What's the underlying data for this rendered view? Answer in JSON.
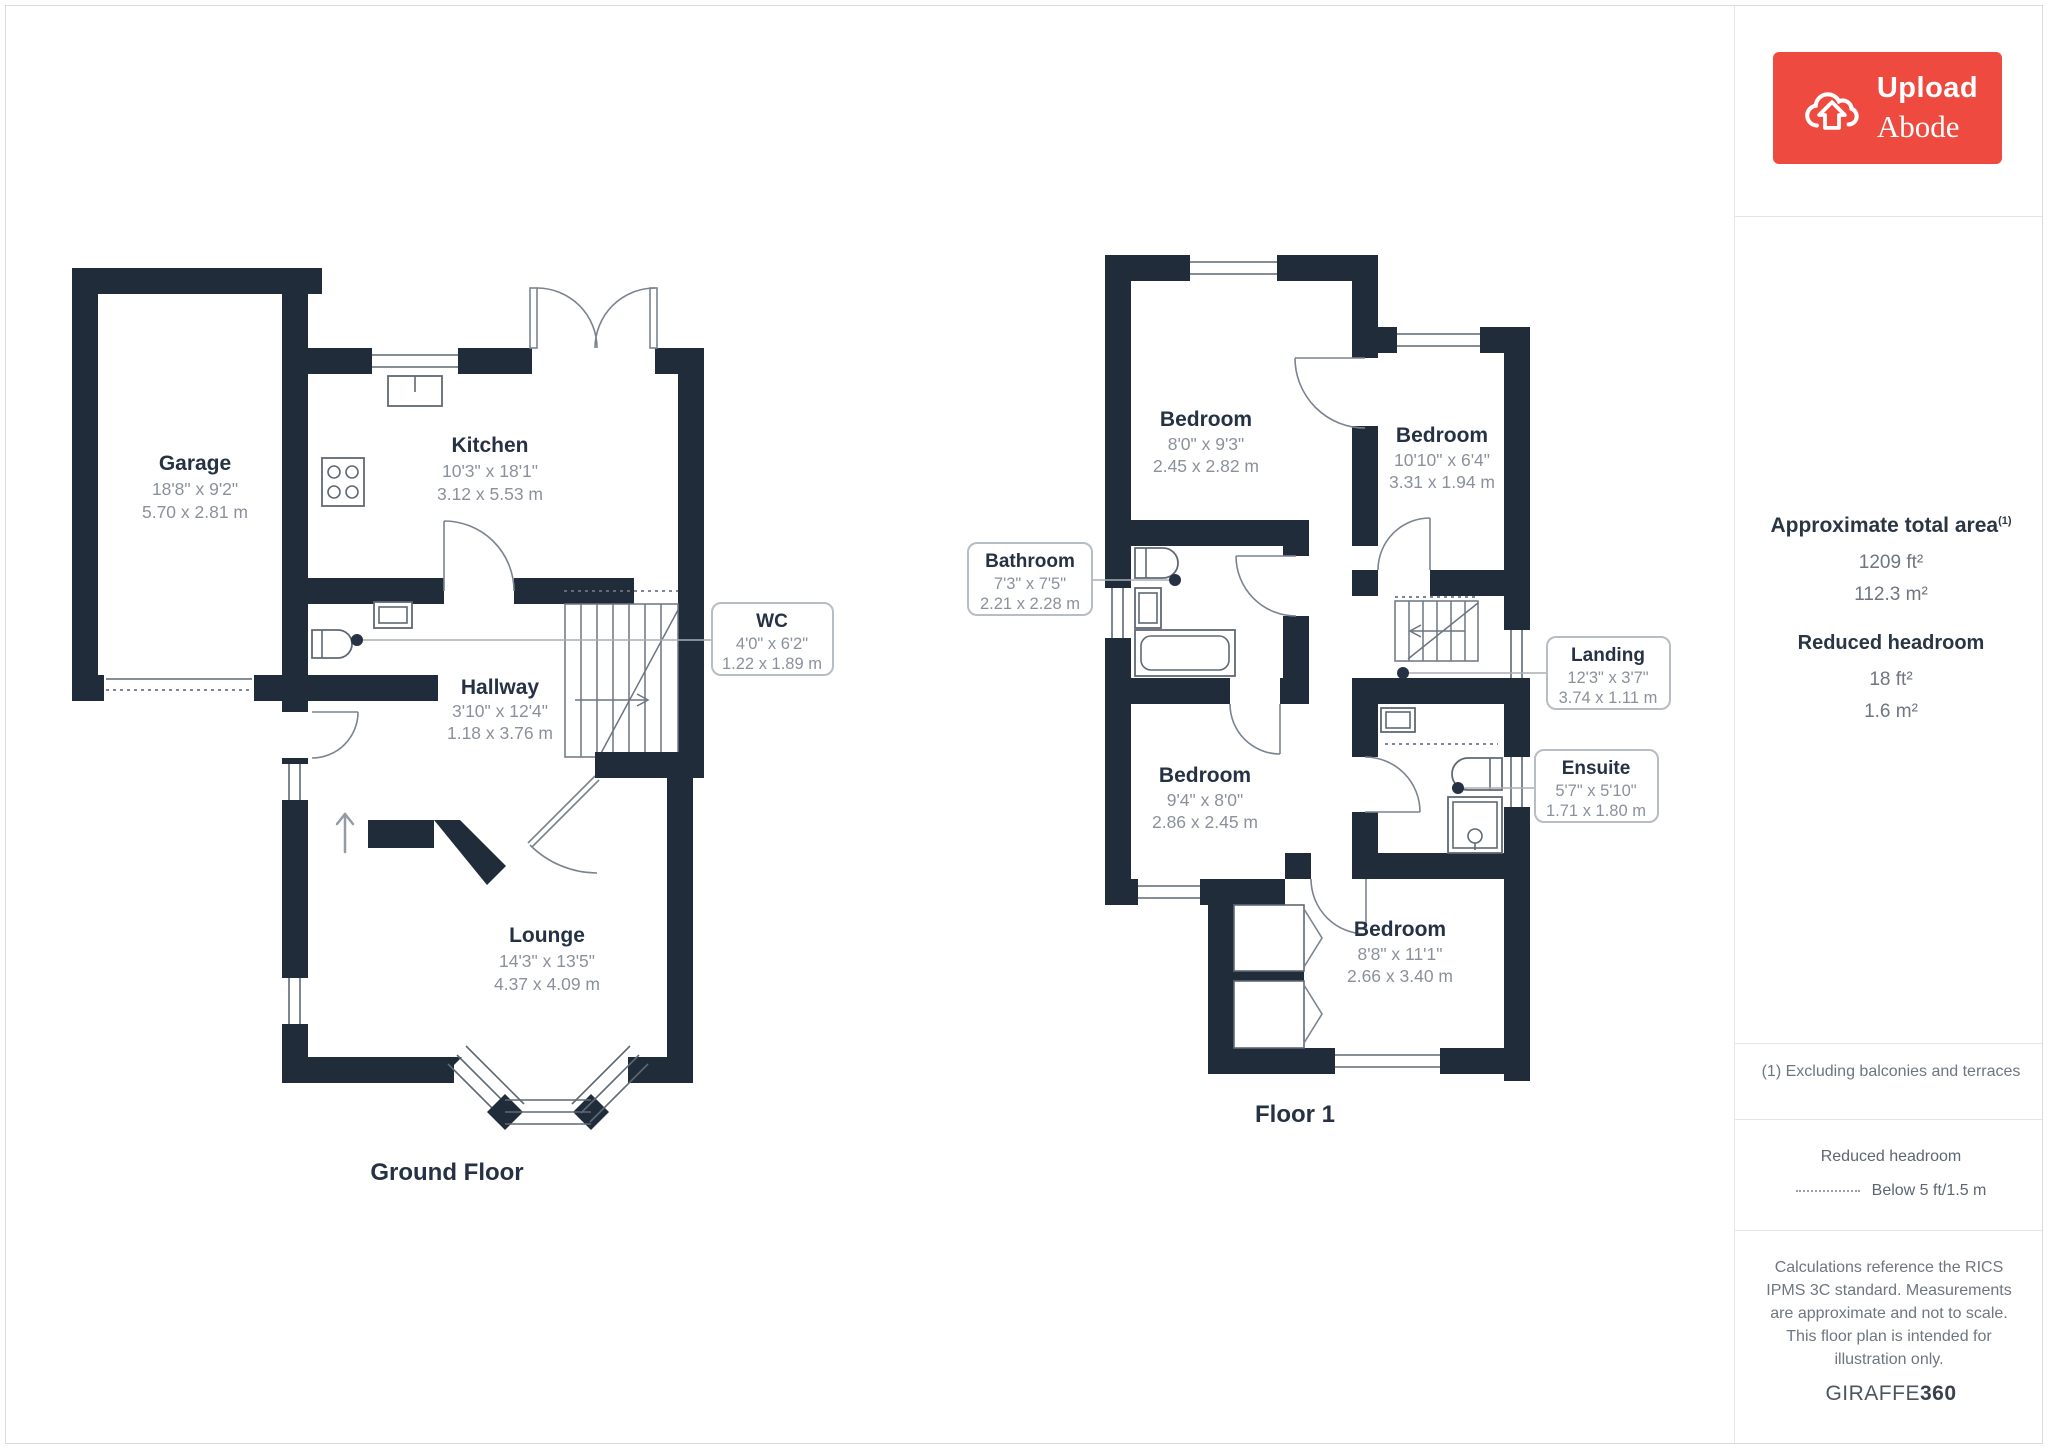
{
  "branding": {
    "logo_word1": "Upload",
    "logo_word2": "Abode",
    "brand_red": "#ee4a3f"
  },
  "sidebar": {
    "area_heading": "Approximate total area",
    "area_note_ref": "(1)",
    "area_ft": "1209 ft²",
    "area_m": "112.3 m²",
    "headroom_heading": "Reduced headroom",
    "headroom_ft": "18 ft²",
    "headroom_m": "1.6 m²",
    "footnote": "(1) Excluding balconies and terraces",
    "legend_title": "Reduced headroom",
    "legend_label": "Below 5 ft/1.5 m",
    "disclaimer": "Calculations reference the RICS IPMS 3C standard. Measurements are approximate and not to scale. This floor plan is intended for illustration only.",
    "brand_footer_regular": "GIRAFFE",
    "brand_footer_bold": "360"
  },
  "colors": {
    "wall": "#212c3b",
    "room_name": "#263244",
    "dimension_text": "#8b919c"
  },
  "floors": {
    "ground": {
      "caption": "Ground Floor",
      "rooms": {
        "garage": {
          "name": "Garage",
          "imperial": "18'8\" x 9'2\"",
          "metric": "5.70 x 2.81 m"
        },
        "kitchen": {
          "name": "Kitchen",
          "imperial": "10'3\" x 18'1\"",
          "metric": "3.12 x 5.53 m"
        },
        "wc": {
          "name": "WC",
          "imperial": "4'0\" x 6'2\"",
          "metric": "1.22 x 1.89 m"
        },
        "hallway": {
          "name": "Hallway",
          "imperial": "3'10\" x 12'4\"",
          "metric": "1.18 x 3.76 m"
        },
        "lounge": {
          "name": "Lounge",
          "imperial": "14'3\" x 13'5\"",
          "metric": "4.37 x 4.09 m"
        }
      }
    },
    "first": {
      "caption": "Floor 1",
      "rooms": {
        "bedroom_top_left": {
          "name": "Bedroom",
          "imperial": "8'0\" x 9'3\"",
          "metric": "2.45 x 2.82 m"
        },
        "bedroom_top_right": {
          "name": "Bedroom",
          "imperial": "10'10\" x 6'4\"",
          "metric": "3.31 x 1.94 m"
        },
        "bathroom": {
          "name": "Bathroom",
          "imperial": "7'3\" x 7'5\"",
          "metric": "2.21 x 2.28 m"
        },
        "landing": {
          "name": "Landing",
          "imperial": "12'3\" x 3'7\"",
          "metric": "3.74 x 1.11 m"
        },
        "ensuite": {
          "name": "Ensuite",
          "imperial": "5'7\" x 5'10\"",
          "metric": "1.71 x 1.80 m"
        },
        "bedroom_mid": {
          "name": "Bedroom",
          "imperial": "9'4\" x 8'0\"",
          "metric": "2.86 x 2.45 m"
        },
        "bedroom_bottom": {
          "name": "Bedroom",
          "imperial": "8'8\" x 11'1\"",
          "metric": "2.66 x 3.40 m"
        }
      }
    }
  }
}
